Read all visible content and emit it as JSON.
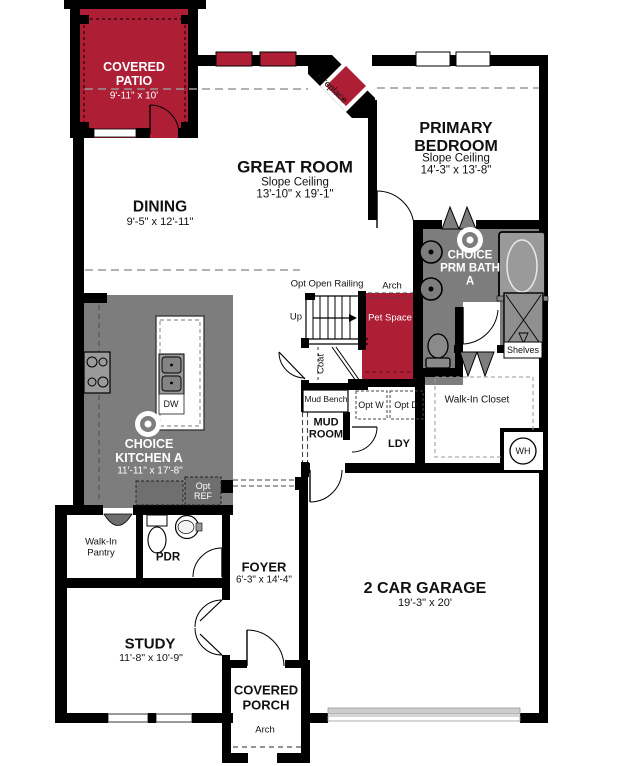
{
  "colors": {
    "accent_red": "#AE1F36",
    "room_gray": "#7D7D7D",
    "wall_black": "#000000"
  },
  "rooms": {
    "covered_patio": {
      "name": "COVERED PATIO",
      "dims": "9'-11\" x 10'"
    },
    "great_room": {
      "name": "GREAT ROOM",
      "ceiling": "Slope Ceiling",
      "dims": "13'-10\" x 19'-1\""
    },
    "dining": {
      "name": "DINING",
      "dims": "9'-5\" x 12'-11\""
    },
    "primary_bedroom": {
      "name": "PRIMARY BEDROOM",
      "ceiling": "Slope Ceiling",
      "dims": "14'-3\" x 13'-8\""
    },
    "primary_bath": {
      "name": "CHOICE PRM BATH A"
    },
    "walk_in_closet": {
      "name": "Walk-In Closet"
    },
    "kitchen": {
      "name": "CHOICE KITCHEN A",
      "dims": "11'-11\" x 17'-8\""
    },
    "mud_room": {
      "name": "MUD ROOM"
    },
    "laundry": {
      "name": "LDY"
    },
    "pantry": {
      "name": "Walk-In Pantry"
    },
    "powder": {
      "name": "PDR"
    },
    "foyer": {
      "name": "FOYER",
      "dims": "6'-3\" x 14'-4\""
    },
    "study": {
      "name": "STUDY",
      "dims": "11'-8\" x 10'-9\""
    },
    "garage": {
      "name": "2 CAR GARAGE",
      "dims": "19'-3\" x 20'"
    },
    "covered_porch": {
      "name": "COVERED PORCH"
    },
    "pet_space": {
      "name": "Pet Space"
    }
  },
  "annotations": {
    "fireplace": "Fireplace",
    "opt_open_railing": "Opt Open Railing",
    "up": "Up",
    "arch_hall": "Arch",
    "arch_porch": "Arch",
    "coat": "Coat",
    "mud_bench": "Mud Bench",
    "opt_w": "Opt W",
    "opt_d": "Opt D",
    "opt_ref": "Opt REF",
    "dw": "DW",
    "shelves": "Shelves",
    "wh": "WH"
  }
}
